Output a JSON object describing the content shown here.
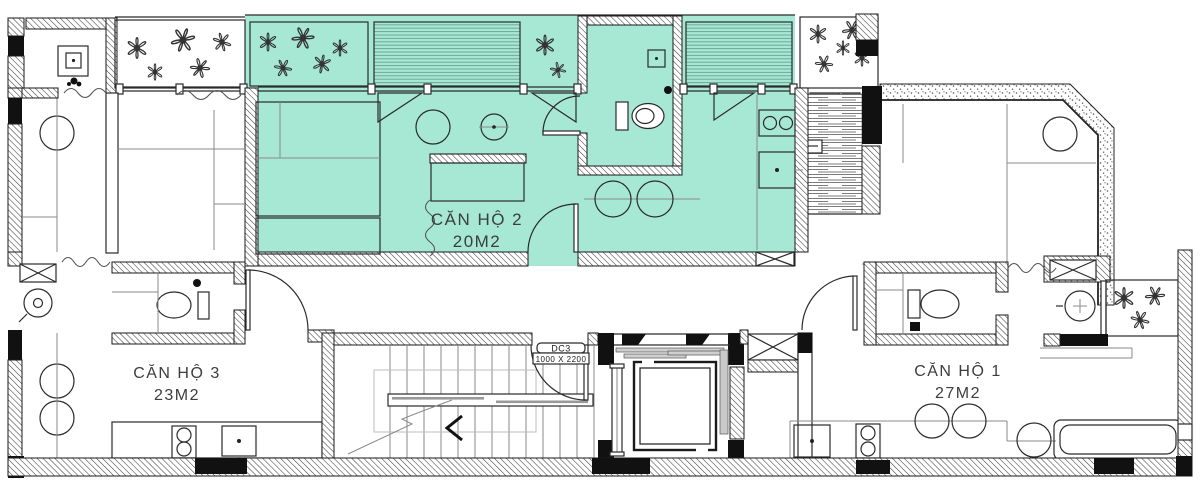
{
  "units": [
    {
      "id": "can-ho-2",
      "name": "CĂN HỘ 2",
      "area_label": "20M2",
      "highlighted": true
    },
    {
      "id": "can-ho-3",
      "name": "CĂN HỘ 3",
      "area_label": "23M2",
      "highlighted": false
    },
    {
      "id": "can-ho-1",
      "name": "CĂN HỘ 1",
      "area_label": "27M2",
      "highlighted": false
    }
  ],
  "door_tag": {
    "code": "DC3",
    "size": "1000 X 2200"
  },
  "colors": {
    "highlight_fill": "#a6e8d4",
    "wall_hatch_line": "#3f3f3f",
    "outline": "#1a1a1a",
    "black_column": "#111111",
    "light_line": "#999999",
    "louver_line": "#6fa695",
    "stipple_dot": "#555555",
    "label_text": "#3d3d3d"
  }
}
